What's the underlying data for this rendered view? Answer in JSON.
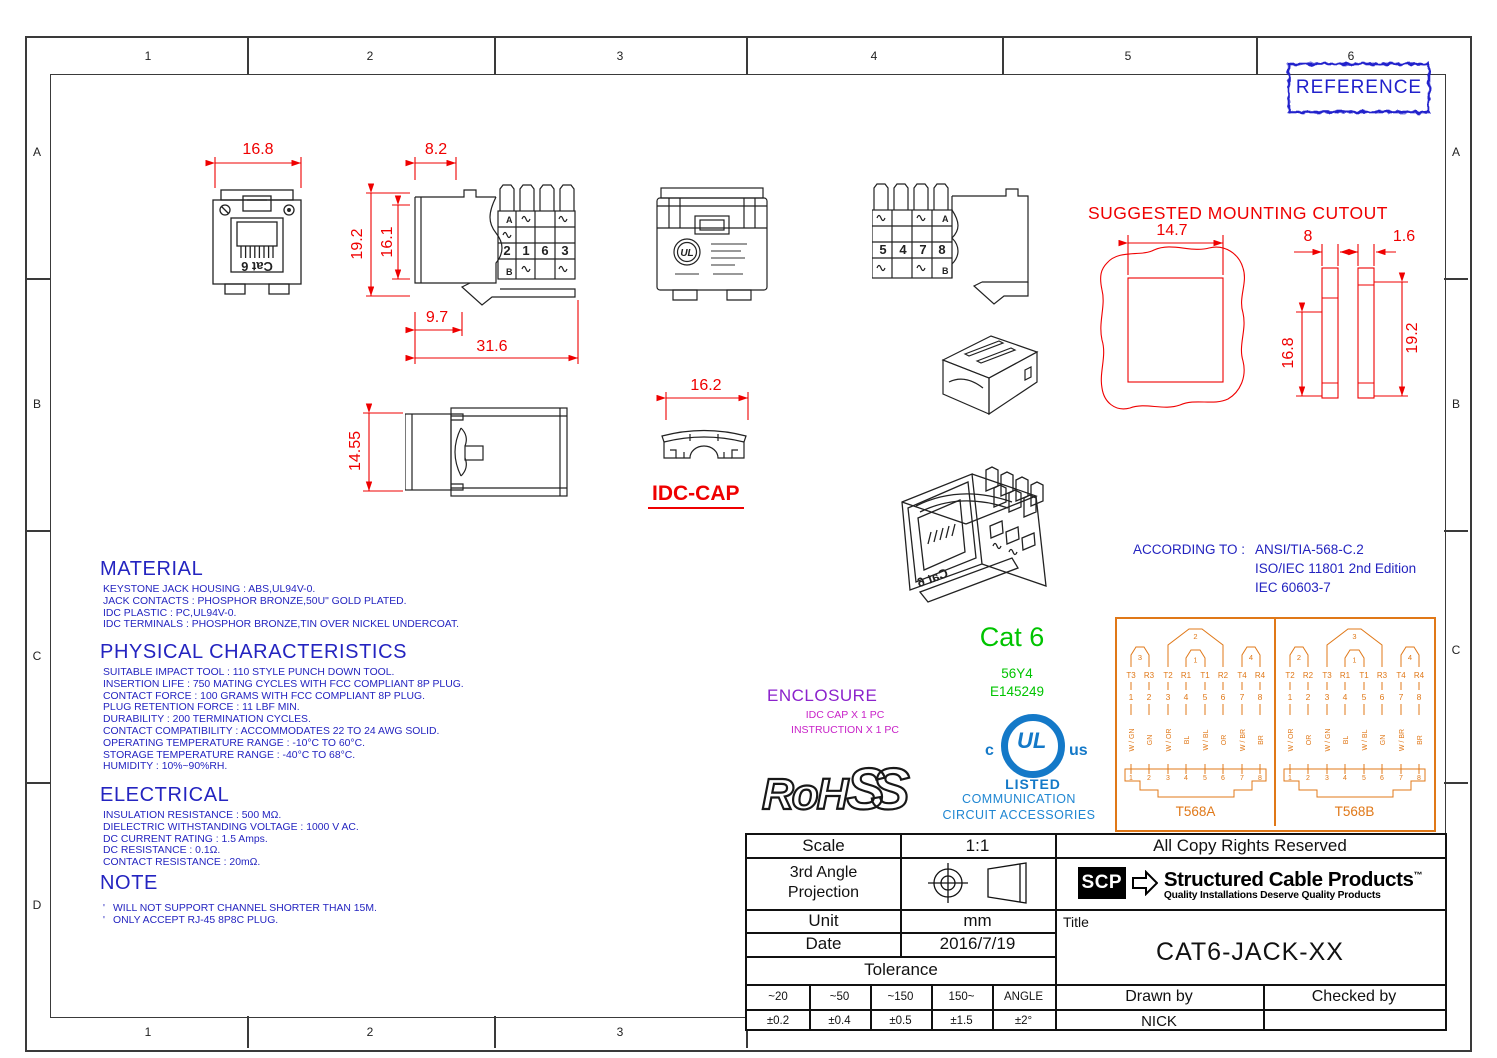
{
  "zones": {
    "top": [
      "1",
      "2",
      "3",
      "4",
      "5",
      "6"
    ],
    "bottom": [
      "1",
      "2",
      "3"
    ],
    "left": [
      "A",
      "B",
      "C",
      "D"
    ],
    "right": [
      "A",
      "B",
      "C"
    ]
  },
  "reference_label": "REFERENCE",
  "cutout": {
    "title": "SUGGESTED MOUNTING CUTOUT",
    "dim_width": "14.7",
    "dim_plate": "8",
    "dim_gap": "1.6",
    "dim_hole": "16.8",
    "dim_panel": "19.2"
  },
  "front": {
    "dim_width": "16.8",
    "label": "Cat 6"
  },
  "side_left": {
    "dim_top": "8.2",
    "dim_height": "19.2",
    "dim_inner": "16.1",
    "dim_depth": "9.7",
    "dim_total": "31.6",
    "row_top": "A",
    "row_bottom": "B",
    "pins": [
      "2",
      "1",
      "6",
      "3"
    ]
  },
  "side_right": {
    "row_top": "A",
    "row_bottom": "B",
    "pins": [
      "5",
      "4",
      "7",
      "8"
    ]
  },
  "top_view": {
    "dim_height": "14.55"
  },
  "idc_cap": {
    "dim_width": "16.2",
    "label": "IDC-CAP"
  },
  "material": {
    "heading": "MATERIAL",
    "lines": [
      "KEYSTONE JACK HOUSING : ABS,UL94V-0.",
      "JACK CONTACTS : PHOSPHOR BRONZE,50U\" GOLD PLATED.",
      "IDC PLASTIC : PC,UL94V-0.",
      "IDC TERMINALS : PHOSPHOR BRONZE,TIN OVER NICKEL UNDERCOAT."
    ]
  },
  "physical": {
    "heading": "PHYSICAL CHARACTERISTICS",
    "lines": [
      "SUITABLE IMPACT TOOL : 110 STYLE PUNCH DOWN TOOL.",
      "INSERTION LIFE : 750 MATING CYCLES WITH FCC COMPLIANT 8P PLUG.",
      "CONTACT FORCE : 100 GRAMS WITH FCC COMPLIANT 8P PLUG.",
      "PLUG RETENTION FORCE : 11 LBF MIN.",
      "DURABILITY : 200 TERMINATION CYCLES.",
      "CONTACT COMPATIBILITY : ACCOMMODATES 22 TO 24 AWG SOLID.",
      "OPERATING TEMPERATURE RANGE : -10°C TO 60°C.",
      "STORAGE TEMPERATURE RANGE : -40°C TO 68°C.",
      "HUMIDITY : 10%~90%RH."
    ]
  },
  "electrical": {
    "heading": "ELECTRICAL",
    "lines": [
      "INSULATION RESISTANCE : 500 MΩ.",
      "DIELECTRIC WITHSTANDING VOLTAGE : 1000 V AC.",
      "DC CURRENT RATING : 1.5 Amps.",
      "DC RESISTANCE : 0.1Ω.",
      "CONTACT RESISTANCE : 20mΩ."
    ]
  },
  "note": {
    "heading": "NOTE",
    "bullet": "'",
    "lines": [
      "WILL NOT SUPPORT CHANNEL SHORTER THAN 15M.",
      "ONLY ACCEPT RJ-45 8P8C PLUG."
    ]
  },
  "enclosure": {
    "heading": "ENCLOSURE",
    "lines": [
      "IDC CAP X 1 PC",
      "INSTRUCTION X 1 PC"
    ]
  },
  "standards": {
    "prefix": "ACCORDING TO :",
    "items": [
      "ANSI/TIA-568-C.2",
      "ISO/IEC 11801 2nd Edition",
      "IEC 60603-7"
    ]
  },
  "cert": {
    "category": "Cat 6",
    "ul_code": "56Y4",
    "ul_file": "E145249",
    "ul_c": "c",
    "ul_letters": "UL",
    "ul_us": "us",
    "ul_listed": "LISTED",
    "desc1": "COMMUNICATION",
    "desc2": "CIRCUIT ACCESSORIES",
    "rohs_a": "RoH",
    "rohs_b": "SS"
  },
  "wiring": {
    "t568a": {
      "label": "T568A",
      "bracket_left": "3",
      "bracket_big": "2",
      "bracket_nested": "1",
      "bracket_right": "4",
      "signals": [
        "T3",
        "R3",
        "T2",
        "R1",
        "T1",
        "R2",
        "T4",
        "R4"
      ],
      "pins": [
        "1",
        "2",
        "3",
        "4",
        "5",
        "6",
        "7",
        "8"
      ],
      "colors": [
        "W / GN",
        "GN",
        "W / OR",
        "BL",
        "W / BL",
        "OR",
        "W / BR",
        "BR"
      ]
    },
    "t568b": {
      "label": "T568B",
      "bracket_left": "2",
      "bracket_big": "3",
      "bracket_nested": "1",
      "bracket_right": "4",
      "signals": [
        "T2",
        "R2",
        "T3",
        "R1",
        "T1",
        "R3",
        "T4",
        "R4"
      ],
      "pins": [
        "1",
        "2",
        "3",
        "4",
        "5",
        "6",
        "7",
        "8"
      ],
      "colors": [
        "W / OR",
        "OR",
        "W / GN",
        "BL",
        "W / BL",
        "GN",
        "W / BR",
        "BR"
      ]
    }
  },
  "title_block": {
    "scale_label": "Scale",
    "scale_value": "1:1",
    "projection_line1": "3rd Angle",
    "projection_line2": "Projection",
    "unit_label": "Unit",
    "unit_value": "mm",
    "date_label": "Date",
    "date_value": "2016/7/19",
    "tolerance_label": "Tolerance",
    "tol_headers": [
      "~20",
      "~50",
      "~150",
      "150~",
      "ANGLE"
    ],
    "tol_values": [
      "±0.2",
      "±0.4",
      "±0.5",
      "±1.5",
      "±2°"
    ],
    "copyright": "All Copy Rights Reserved",
    "brand_abbr": "SCP",
    "brand_name": "Structured Cable Products",
    "brand_tm": "™",
    "brand_tagline": "Quality Installations Deserve Quality Products",
    "title_label": "Title",
    "title_value": "CAT6-JACK-XX",
    "drawn_label": "Drawn by",
    "drawn_value": "NICK",
    "checked_label": "Checked by",
    "checked_value": ""
  }
}
